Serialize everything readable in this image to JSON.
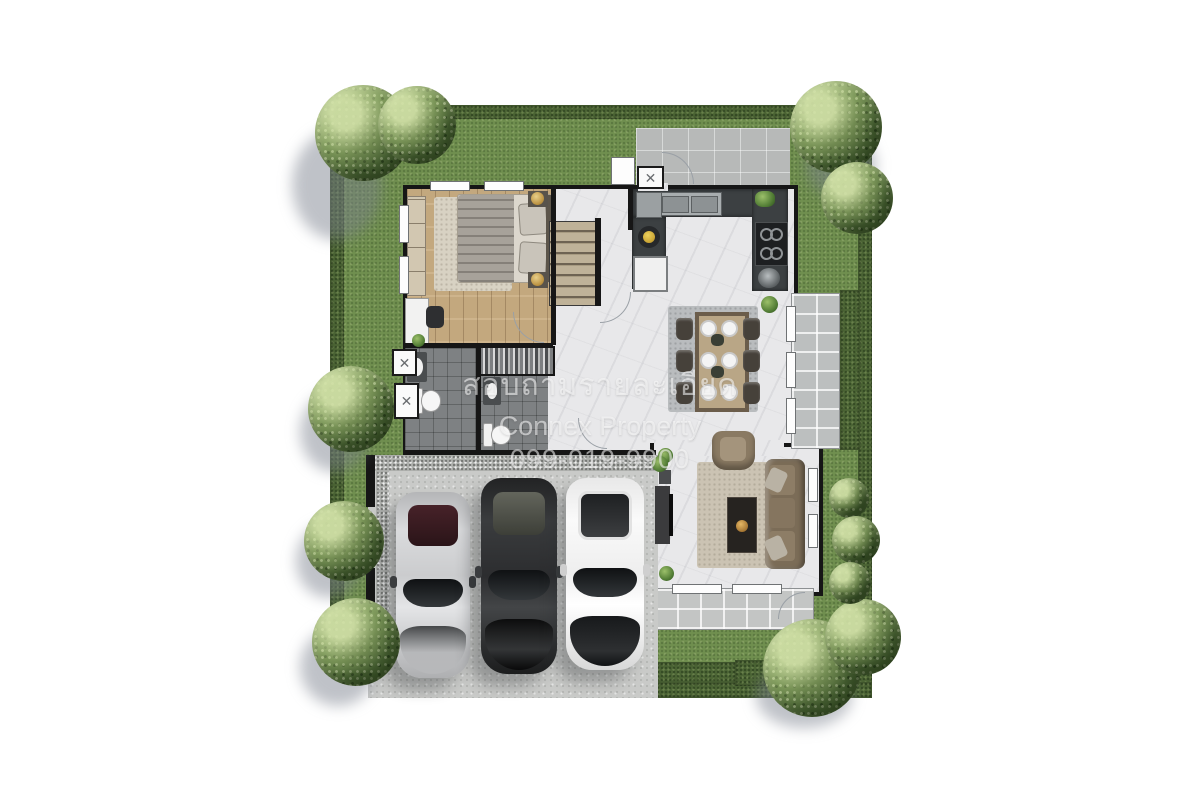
{
  "watermark": {
    "line1": "สอบถามรายละเอียด",
    "line2": "Connex Property",
    "line3": "099-019-9900"
  },
  "ac_unit_glyph": "✕",
  "palette": {
    "background": "#ffffff",
    "grass": "#708f4f",
    "hedge": "#4c6535",
    "wall": "#161616",
    "marble_floor": "#e8e8ea",
    "wood_floor": "#c3a87e",
    "bathroom_tile": "#7e8183",
    "kitchen_counter": "#3c4042",
    "garage_concrete": "#c9cac8",
    "paving": "#b7b9b8",
    "stair_wood": "#b5a88d",
    "sofa_brown": "#7b6c57",
    "car_silver": "#c6c7c9",
    "car_black": "#2b2c2d",
    "car_white": "#f2f2f2"
  },
  "scene": {
    "garden": [
      "lawn",
      "perimeter-hedge",
      "trees",
      "shrubs"
    ],
    "house_rooms": [
      "bedroom",
      "stair-hall",
      "kitchen",
      "dining-area",
      "living-room",
      "bathroom",
      "bathroom",
      "closet"
    ],
    "outdoor": [
      "entry-walkway",
      "side-patio",
      "rear-terrace",
      "garage-driveway"
    ],
    "cars": [
      "silver-car",
      "black-car",
      "white-car"
    ]
  }
}
